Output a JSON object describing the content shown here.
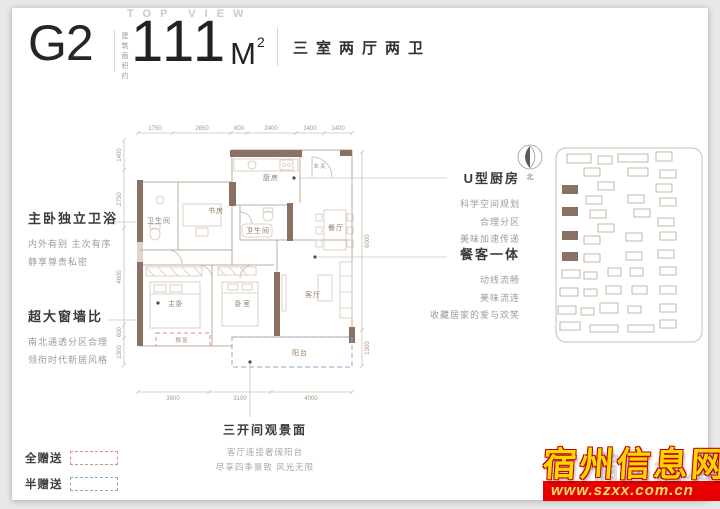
{
  "header": {
    "top_view": "TOP VIEW",
    "unit_code": "G2",
    "area_prefix": "建筑面积约",
    "area_value": "111",
    "area_unit": "M",
    "area_sup": "2",
    "layout_desc": "三室两厅两卫"
  },
  "annotations": {
    "left": [
      {
        "title": "主卧独立卫浴",
        "lines": [
          "内外有别 主次有序",
          "静享尊贵私密"
        ]
      },
      {
        "title": "超大窗墙比",
        "lines": [
          "南北通透分区合理",
          "领衔时代新居风格"
        ]
      }
    ],
    "right": [
      {
        "title": "U型厨房",
        "lines": [
          "科学空间规划",
          "合理分区",
          "美味加速传递"
        ]
      },
      {
        "title": "餐客一体",
        "lines": [
          "动线流畅",
          "美味流连",
          "收藏居家的爱与欢笑"
        ]
      }
    ],
    "bottom": {
      "title": "三开间观景面",
      "lines": [
        "客厅连接奢阔阳台",
        "尽享四季景致 风光无限"
      ]
    }
  },
  "legend": {
    "full": {
      "label": "全赠送",
      "color": "#d98f8f"
    },
    "half": {
      "label": "半赠送",
      "color": "#93a5c4"
    }
  },
  "floorplan": {
    "rooms": {
      "bath1": "卫生间",
      "study": "书房",
      "kitchen": "厨房",
      "bath2": "卫生间",
      "dining": "餐厅",
      "entry": "玄关",
      "master": "主卧",
      "bedroom2": "卧室",
      "living": "客厅",
      "balcony": "阳台",
      "baywindow": "飘窗"
    },
    "dims_top": [
      "1750",
      "2850",
      "800",
      "2400",
      "1400",
      "1400"
    ],
    "dims_left": [
      "1400",
      "2750",
      "4600",
      "600",
      "1300"
    ],
    "dims_right": [
      "6000",
      "1300"
    ],
    "dims_bottom": [
      "3500",
      "3100",
      "4000"
    ]
  },
  "siteplan": {
    "compass_label": "北"
  },
  "watermark": {
    "site_name": "宿州信息网",
    "site_url": "www.szxx.com.cn"
  },
  "colors": {
    "wall": "#8a7164",
    "full_gift": "#d98f8f",
    "half_gift": "#93a5c4",
    "watermark_gold": "#ffd700",
    "watermark_red": "#e80000"
  }
}
